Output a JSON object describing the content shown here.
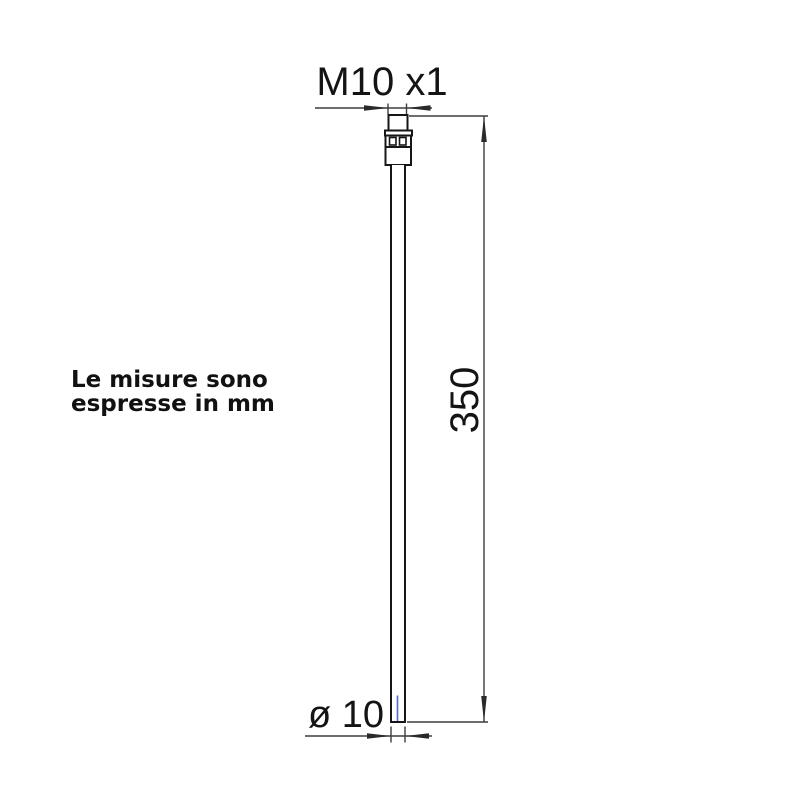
{
  "note": {
    "line1": "Le misure sono",
    "line2": "espresse in mm"
  },
  "dimensions": {
    "thread_label": "M10 x1",
    "length_label": "350",
    "diameter_label": "ø 10"
  },
  "part": {
    "type": "rigid-tail-tube-with-threaded-fitting",
    "thread": "M10 x1",
    "length_mm": 350,
    "diameter_mm": 10
  },
  "colors": {
    "background": "#ffffff",
    "outline": "#161616",
    "dimension_line": "#3d3d3d",
    "text": "#141414",
    "probe_blue": "#4a6fd0"
  }
}
